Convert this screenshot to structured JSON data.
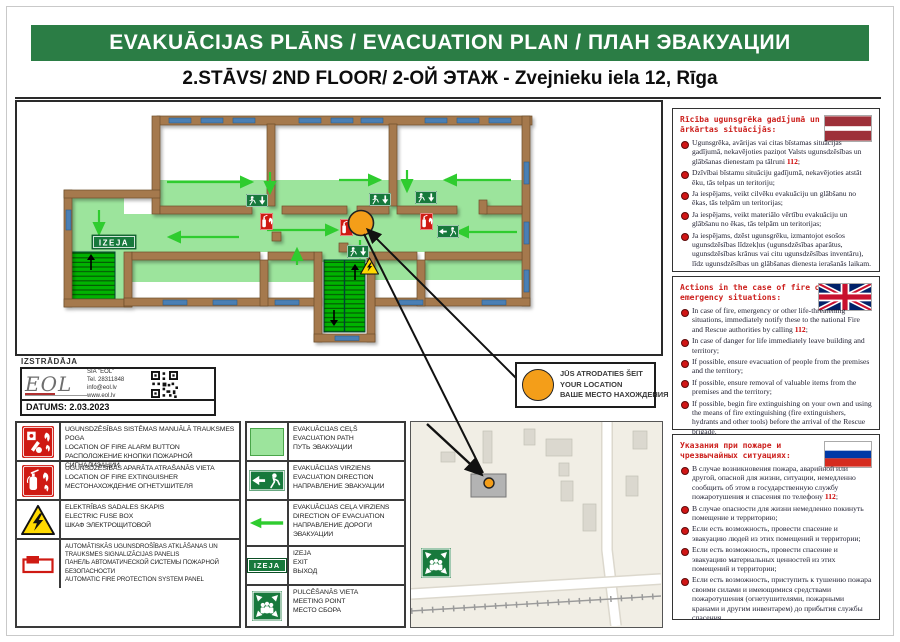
{
  "header": {
    "title": "EVAKUĀCIJAS PLĀNS / EVACUATION PLAN / ПЛАН ЭВАКУАЦИИ",
    "subtitle": "2.STĀVS/ 2ND FLOOR/ 2-ОЙ ЭТАЖ - Zvejnieku iela 12, Rīga"
  },
  "plan": {
    "izeja": "IZEJA",
    "location": {
      "lines": [
        "JŪS ATRODATIES ŠEIT",
        "YOUR LOCATION",
        "ВАШЕ МЕСТО НАХОЖДЕНИЯ"
      ]
    }
  },
  "developer": {
    "label": "IZSTRĀDĀJA",
    "logo": "EOL",
    "lines": [
      "SIA \"EOL\"",
      "Tel. 28311848",
      "info@eol.lv",
      "www.eol.lv"
    ],
    "date": "DATUMS: 2.03.2023"
  },
  "legend_left": {
    "rows": [
      {
        "lines": [
          "UGUNSDZĒSĪBAS SISTĒMAS MANUĀLĀ TRAUKSMES POGA",
          "LOCATION OF FIRE ALARM BUTTON",
          "РАСПОЛОЖЕНИЕ КНОПКИ ПОЖАРНОЙ СИГНАЛИЗАЦИИ"
        ]
      },
      {
        "lines": [
          "UGUNSDZĒSĪBAS APARĀTA ATRAŠANĀS VIETA",
          "LOCATION OF FIRE EXTINGUISHER",
          "МЕСТОНАХОЖДЕНИЕ ОГНЕТУШИТЕЛЯ"
        ]
      },
      {
        "lines": [
          "ELEKTRĪBAS SADALES SKAPIS",
          "ELECTRIC FUSE BOX",
          "ШКАФ ЭЛЕКТРОЩИТОВОЙ"
        ]
      },
      {
        "lines": [
          "AUTOMĀTISKĀS UGUNSDROŠĪBAS ATKLĀŠANAS UN TRAUKSMES SIGNALIZĀCIJAS PANELIS",
          "ПАНЕЛЬ АВТОМАТИЧЕСКОЙ СИСТЕМЫ ПОЖАРНОЙ БЕЗОПАСНОСТИ",
          "AUTOMATIC FIRE PROTECTION SYSTEM PANEL"
        ]
      }
    ]
  },
  "legend_mid": {
    "rows": [
      {
        "lines": [
          "EVAKUĀCIJAS CEĻŠ",
          "EVACUATION PATH",
          "ПУТЬ ЭВАКУАЦИИ"
        ]
      },
      {
        "lines": [
          "EVAKUĀCIJAS VIRZIENS",
          "EVACUATION DIRECTION",
          "НАПРАВЛЕНИЕ ЭВАКУАЦИИ"
        ]
      },
      {
        "lines": [
          "EVAKUĀCIJAS CEĻA VIRZIENS",
          "DIRECTION OF EVACUATION",
          "НАПРАВЛЕНИЕ ДОРОГИ ЭВАКУАЦИИ"
        ]
      },
      {
        "lines": [
          "IZEJA",
          "EXIT",
          "ВЫХОД"
        ]
      },
      {
        "lines": [
          "PULCĒŠANĀS VIETA",
          "MEETING POINT",
          "МЕСТО СБОРА"
        ]
      }
    ]
  },
  "sidebar": {
    "sections": [
      {
        "id": "lv",
        "title": "Rīcība ugunsgrēka gadījumā un ārkārtas situācijās:",
        "bullets": [
          "Ugunsgrēka, avārijas vai citas bīstamas situācijas gadījumā, nekavējoties paziņot Valsts ugunsdzēsības un glābšanas dienestam pa tālruni 112;",
          "Dzīvībai bīstamu situāciju gadījumā, nekavējoties atstāt ēku, tās telpas un teritoriju;",
          "Ja iespējams, veikt cilvēku evakuāciju un glābšanu no ēkas, tās telpām un teritorijas;",
          "Ja iespējams, veikt materiālo vērtību evakuāciju un glābšanu no ēkas, tās telpām un teritorijas;",
          "Ja iespējams, dzēst ugunsgrēku, izmantojot esošos ugunsdzēsības līdzekļus (ugunsdzēsības aparātus, ugunsdzēsības krānus vai citu ugunsdzēsības inventāru), līdz ugunsdzēsības un glābšanas dienesta ierašanās laikam."
        ]
      },
      {
        "id": "en",
        "title": "Actions in the case of fire or emergency situations:",
        "bullets": [
          "In case of fire, emergency or other life-threatening situations, immediately notify these to the national Fire and Rescue authorities by calling 112;",
          "In case of danger for life immediately leave building and territory;",
          "If possible, ensure evacuation of people from the premises and the territory;",
          "If possible, ensure removal of valuable items from the premises and the territory;",
          "If possible, begin fire extinguishing on your own and using the means of fire extinguishing (fire extinguishers, hydrants and other tools) before the arrival of the Rescue brigade."
        ]
      },
      {
        "id": "ru",
        "title": "Указания при пожаре и чрезвычайных ситуациях:",
        "bullets": [
          "В случае возникновения пожара, аварийной или другой, опасной для жизни, ситуации, немедленно сообщить об этом в государственную службу пожаротушения и спасения по телефону 112;",
          "В случае опасности для жизни немедленно покинуть помещение и территорию;",
          "Если есть возможность, провести спасение и эвакуацию людей из этих помещений и территории;",
          "Если есть возможность, провести спасение и эвакуацию материальных ценностей из этих помещений и территории;",
          "Если есть возможность, приступить к тушению пожара своими силами и имеющимися средствами пожаротушения (огнетушителями, пожарными кранами и другим инвентарем) до прибытия службы спасения."
        ]
      }
    ]
  }
}
